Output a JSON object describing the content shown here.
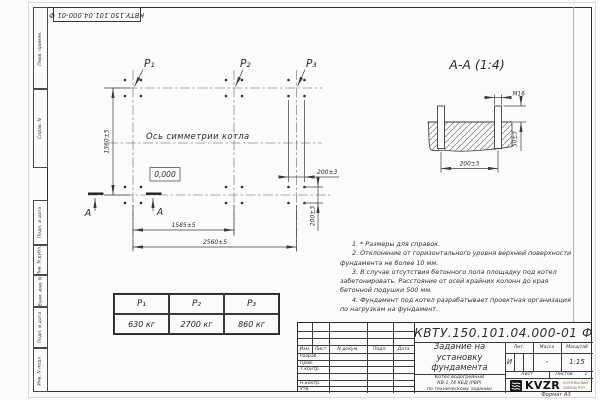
{
  "margin_stamps": [
    "Перв. примен.",
    "Справ. N",
    "Подп. и дата",
    "Инв. N дубл.",
    "Взам. инв. N",
    "Подп. и дата",
    "Инв. N подл."
  ],
  "plan": {
    "p_labels": [
      "P₁",
      "P₂",
      "P₃"
    ],
    "axis_label": "Ось симметрии котла",
    "level_mark": "0,000",
    "dims": {
      "height": "1360±5",
      "span_inner": "1585±5",
      "span_total": "2560±5",
      "bolt_spacing_top": "200±3",
      "bolt_spacing_right": "200±3"
    },
    "section_letters": [
      "А",
      "А"
    ]
  },
  "section": {
    "title": "А-А (1:4)",
    "thread": "М16",
    "dims": {
      "protrusion": "50±3",
      "spacing": "200±3"
    }
  },
  "notes": [
    "1. * Размеры для справок.",
    "2. Отклонение от горизонтального уровня верхней поверхности фундамента не более 10 мм.",
    "3. В случае отсутствия бетонного пола площадку под котел забетонировать. Расстояние от осей крайних колонн до края бетонной подушки 500 мм.",
    "4. Фундамент под котел разрабатывает проектная организация по нагрузкам на фундамент."
  ],
  "load_table": {
    "headers": [
      "P₁",
      "P₂",
      "P₃"
    ],
    "values": [
      "630 кг",
      "2700 кг",
      "860 кг"
    ]
  },
  "title_block": {
    "doc_number": "КВТУ.150.101.04.000-01 Ф",
    "header_cols": [
      "Изм.",
      "Лист",
      "N докум.",
      "Подп.",
      "Дата"
    ],
    "sign_rows": [
      "Разраб.",
      "Пров.",
      "Т.контр.",
      "",
      "Н.контр.",
      "Утв."
    ],
    "title_lines": [
      "Задание на",
      "установку",
      "фундамента"
    ],
    "product_lines": [
      "Котел водогрейный",
      "КВ-1,74 КБД (РВР)",
      "по техническому заданию"
    ],
    "lit_label": "Лит.",
    "lit_value": "И",
    "massa_label": "Масса",
    "massa_value": "-",
    "scale_label": "Масштаб",
    "scale_value": "1:15",
    "list_label": "Лист",
    "listov_label": "Листов",
    "listov_value": "1",
    "logo_text": "KVZR",
    "company_line1": "КОТЕЛЬНЫЙ",
    "company_line2": "ЗАВОД РЭТ",
    "format_note": "Формат А3"
  }
}
